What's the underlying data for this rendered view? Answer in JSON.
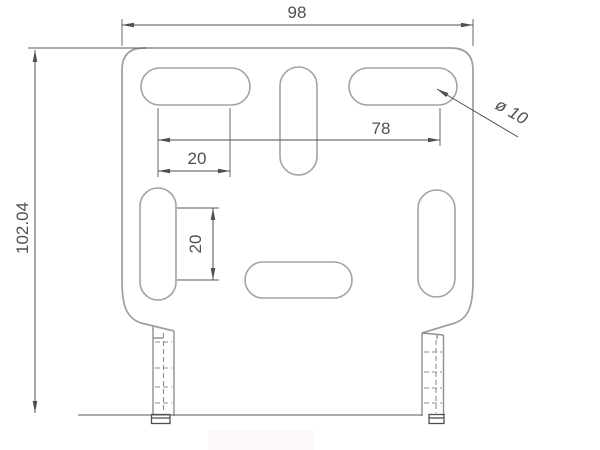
{
  "drawing": {
    "type": "engineering-drawing",
    "part": "slotted bracket plate, front view",
    "dims": {
      "overall_width": "98",
      "overall_height": "102.04",
      "slot_span": "78",
      "slot_pitch_top": "20",
      "slot_pitch_side": "20",
      "hole_diameter": "ø 10"
    },
    "colors": {
      "background": "#ffffff",
      "outline_gray": "#9e9e9e",
      "dimension_gray": "#4f4f4f",
      "watermark_pink": "#fbeaea"
    },
    "features": {
      "slots": 6,
      "legs": 2,
      "hidden_lines": "dashed center lines in both legs"
    }
  }
}
